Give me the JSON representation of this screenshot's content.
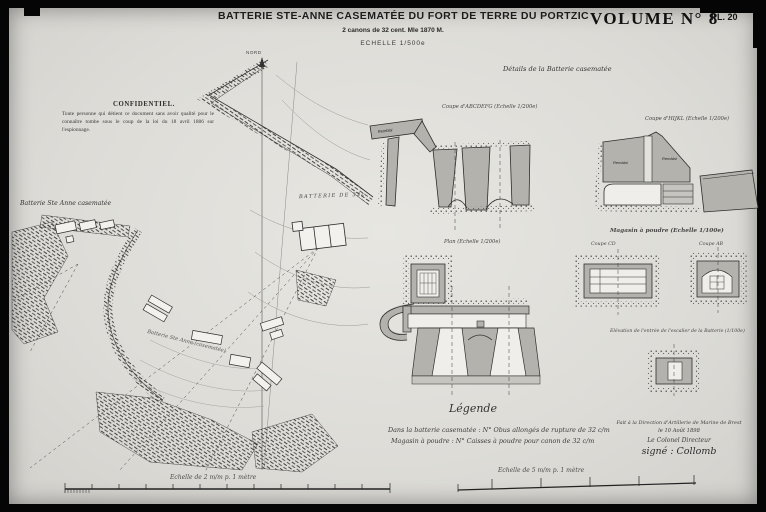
{
  "plate": {
    "title": "BATTERIE STE-ANNE CASEMATÉE DU FORT DE TERRE DU PORTZIC",
    "subtitle": "2 canons de 32 cent. Mle 1870 M.",
    "scale_note": "ECHELLE 1/500e",
    "volume": "VOLUME N° 8",
    "plate_number": "PL. 20"
  },
  "confidentiel": {
    "heading": "CONFIDENTIEL.",
    "body": "Toute personne qui détient ce document sans avoir qualité pour le connaître tombe sous le coup de la loi du 18 avril 1886 sur l'espionnage."
  },
  "site_plan": {
    "label": "Batterie Ste Anne casematée",
    "north_label": "NORD",
    "battery_label": "BATTERIE DE 32c",
    "diagonal_label": "Batterie Ste Anne (casematée)"
  },
  "details": {
    "heading": "Détails de la Batterie casematée",
    "section_left_label": "Coupe d'ABCDEFG (Echelle 1/200e)",
    "section_right_label": "Coupe d'HIJKL (Echelle 1/200e)",
    "plan_label": "Plan (Echelle 1/200e)",
    "magazine_heading": "Magasin à poudre (Echelle 1/100e)",
    "magazine_section_left": "Coupe CD",
    "magazine_section_right": "Coupe AB",
    "elevation_caption": "Elévation de l'entrée de l'escalier de la Batterie (1/100e)",
    "remblai_label": "Remblai"
  },
  "legend": {
    "heading": "Légende",
    "line1": "Dans la batterie casematée : N° Obus allongés de rupture de 32 c/m",
    "line2": "Magasin à poudre : N° Caisses à poudre pour canon de 32 c/m",
    "accent_color": "#2b2b2b"
  },
  "signature": {
    "line1": "Fait à la Direction d'Artillerie de Marine de Brest",
    "line2": "le 10 Août 1898",
    "line3": "Le Colonel Directeur",
    "line4": "signé : Collomb"
  },
  "scales": {
    "left_caption": "Echelle de 2 m/m p. 1 mètre",
    "right_caption": "Echelle de 5 m/m p. 1 mètre"
  }
}
